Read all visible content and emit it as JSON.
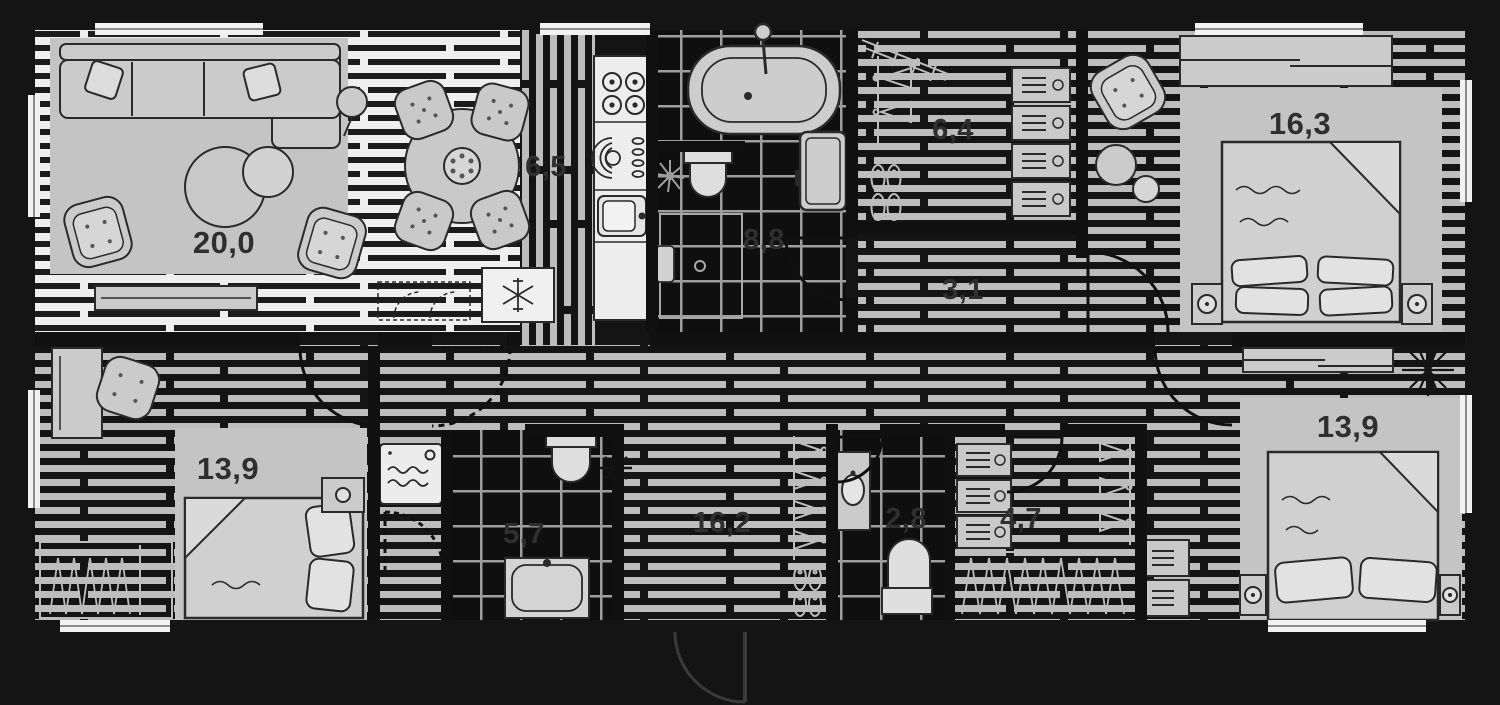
{
  "plan": {
    "kind": "apartment-floor-plan",
    "number_style": "decimal-comma",
    "colors": {
      "background": "#141414",
      "floor_light": "#efefef",
      "floor_stripe_dark": "#1c1c1c",
      "floor_stripe_light": "#bdbdbd",
      "tile_floor": "#0f0f0f",
      "furniture": "#cbcbcb",
      "rug": "#c4c4c4",
      "label_text": "#2f2f2f"
    },
    "rooms": [
      {
        "name": "living-room",
        "area": "20,0"
      },
      {
        "name": "kitchen",
        "area": "6,5"
      },
      {
        "name": "bathroom",
        "area": "8,8"
      },
      {
        "name": "walk-in-closet",
        "area": "6,4"
      },
      {
        "name": "corridor",
        "area": "3,1"
      },
      {
        "name": "bedroom-1",
        "area": "16,3"
      },
      {
        "name": "bedroom-2",
        "area": "13,9"
      },
      {
        "name": "bathroom-2",
        "area": "5,7"
      },
      {
        "name": "hallway",
        "area": "16,2"
      },
      {
        "name": "wc",
        "area": "2,8"
      },
      {
        "name": "closet-2",
        "area": "4,7"
      },
      {
        "name": "bedroom-3",
        "area": "13,9"
      }
    ]
  }
}
